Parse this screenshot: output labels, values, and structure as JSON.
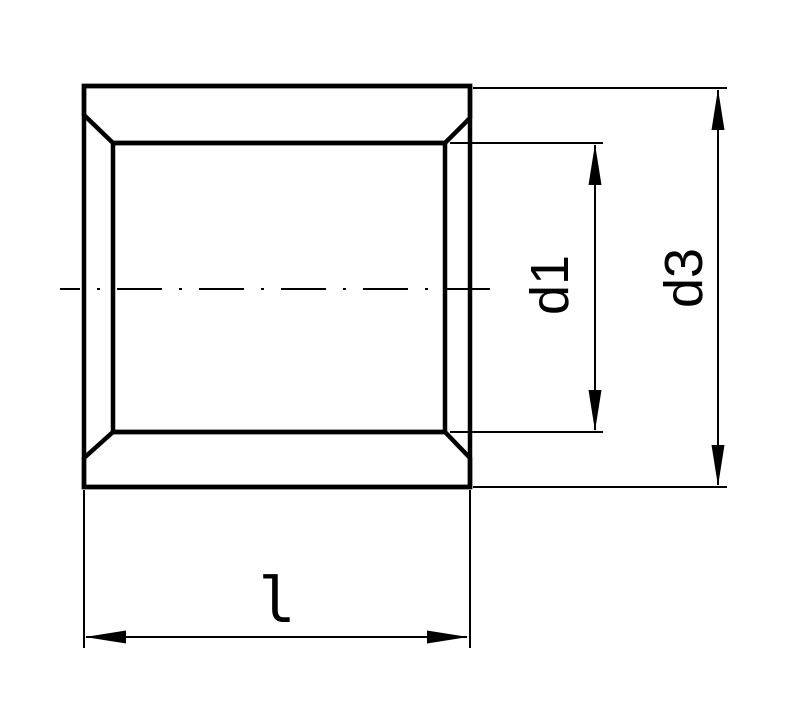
{
  "drawing": {
    "description": "technical section drawing of a cylindrical bushing (sleeve) with chamfered bore ends",
    "view": "full section, hatched walls, horizontal dash-dot axis centerline",
    "colors": {
      "line": "#000000",
      "background": "#ffffff"
    },
    "dimensions": {
      "bore_diameter": {
        "label": "d1",
        "measures": "inner bore diameter"
      },
      "outer_diameter": {
        "label": "d3",
        "measures": "outside diameter"
      },
      "length": {
        "label": "l",
        "measures": "overall length"
      }
    }
  }
}
